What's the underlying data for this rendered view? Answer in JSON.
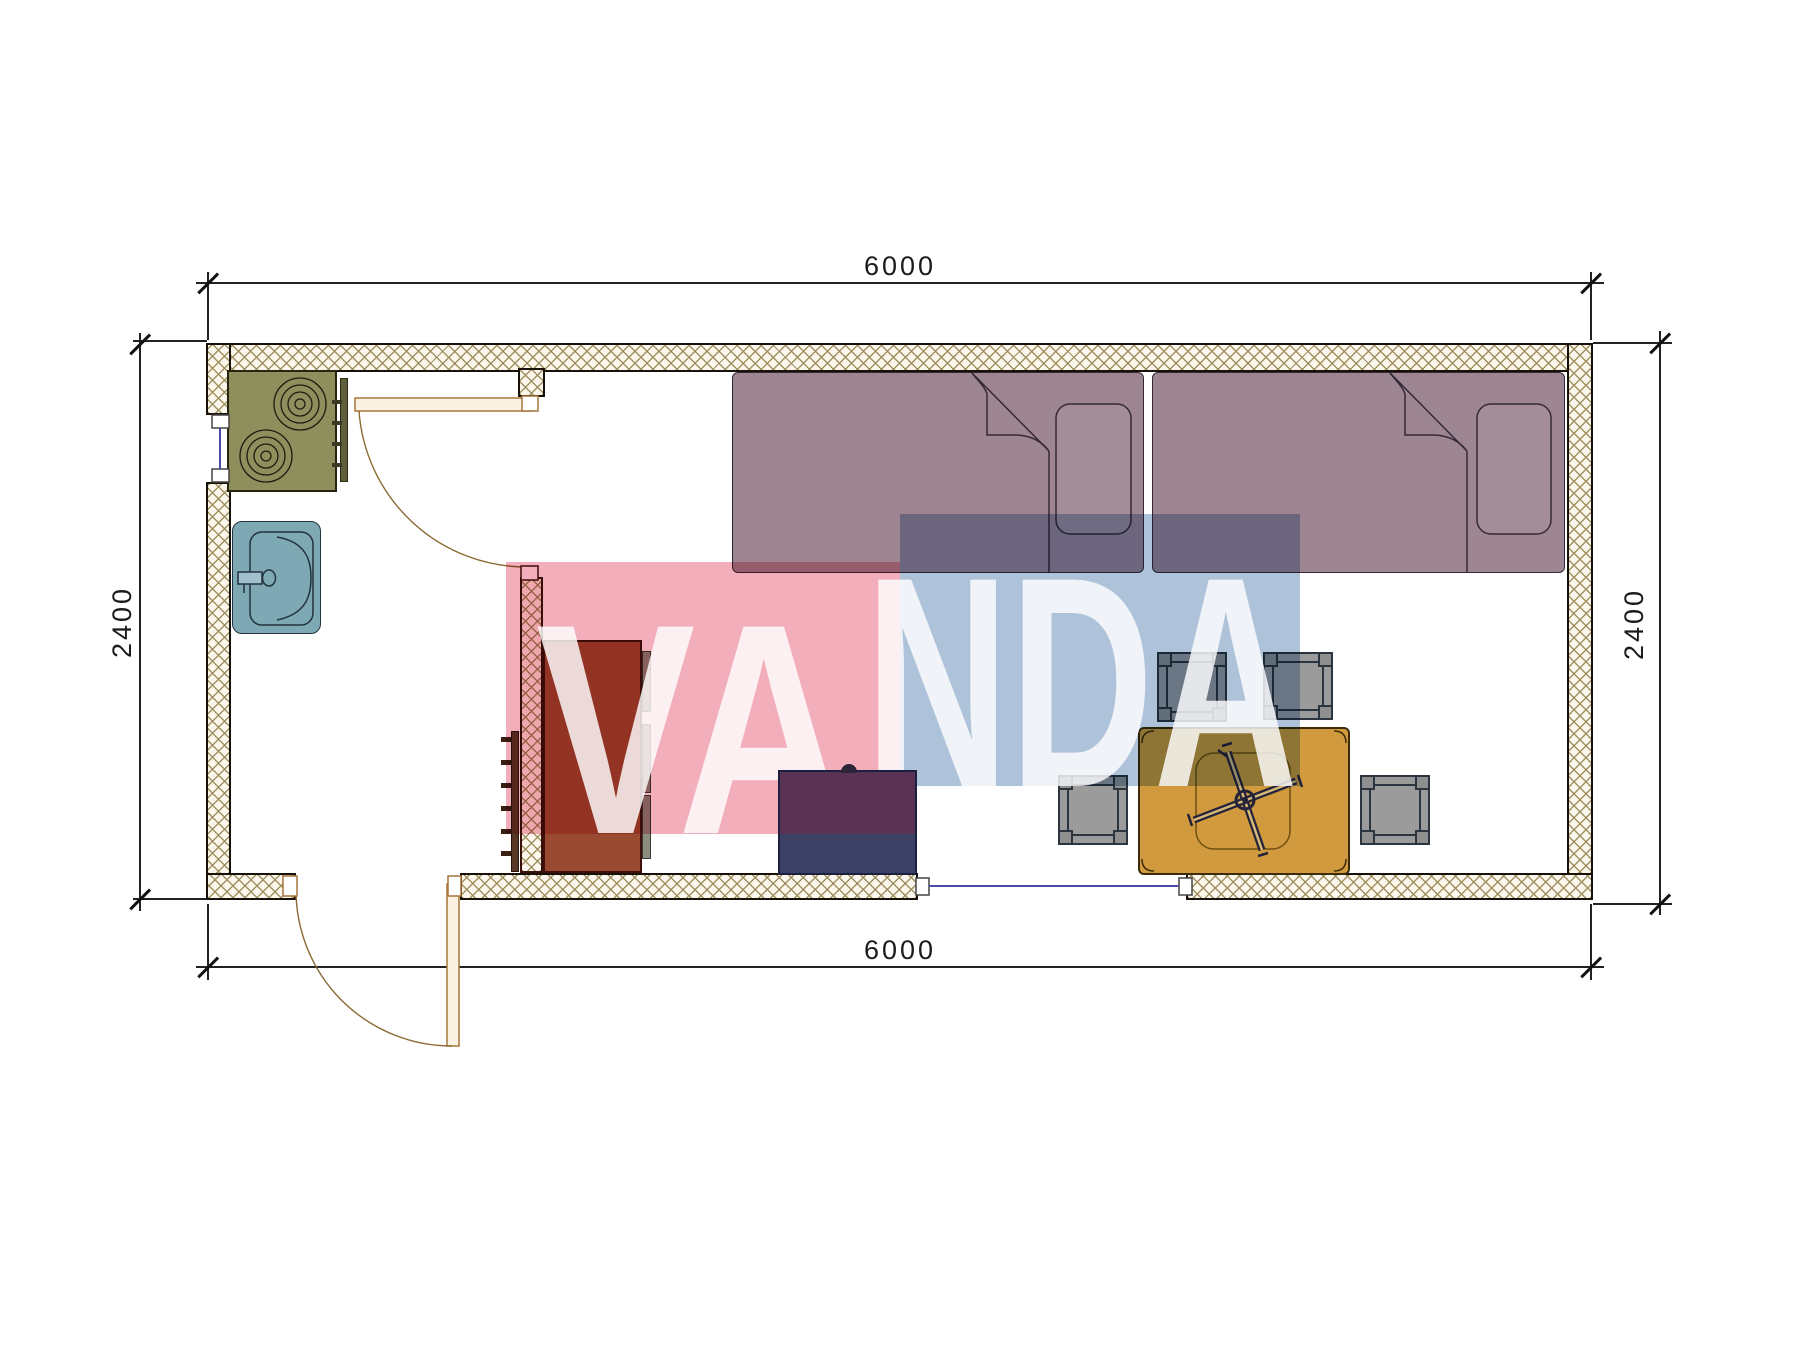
{
  "dimensions": {
    "top": "6000",
    "bottom": "6000",
    "left": "2400",
    "right": "2400"
  },
  "watermark": {
    "text": "VANDA",
    "segment_pink": "VA",
    "segment_blue": "NDA",
    "pink_color": "#f2aebb",
    "blue_color": "#aec2da"
  },
  "colors": {
    "wall_hatch": "#9c8c5c",
    "wall_border": "#17110a",
    "bed": "#9d8692",
    "stove": "#8e8f5d",
    "sink": "#7ea8b4",
    "wardrobe": "#9a4a31",
    "navy_cabinet": "#3d4166",
    "table": "#d19a3e",
    "stool": "#9b9b9b",
    "window_glass": "#4a4aa8",
    "door": "#a8763a"
  }
}
